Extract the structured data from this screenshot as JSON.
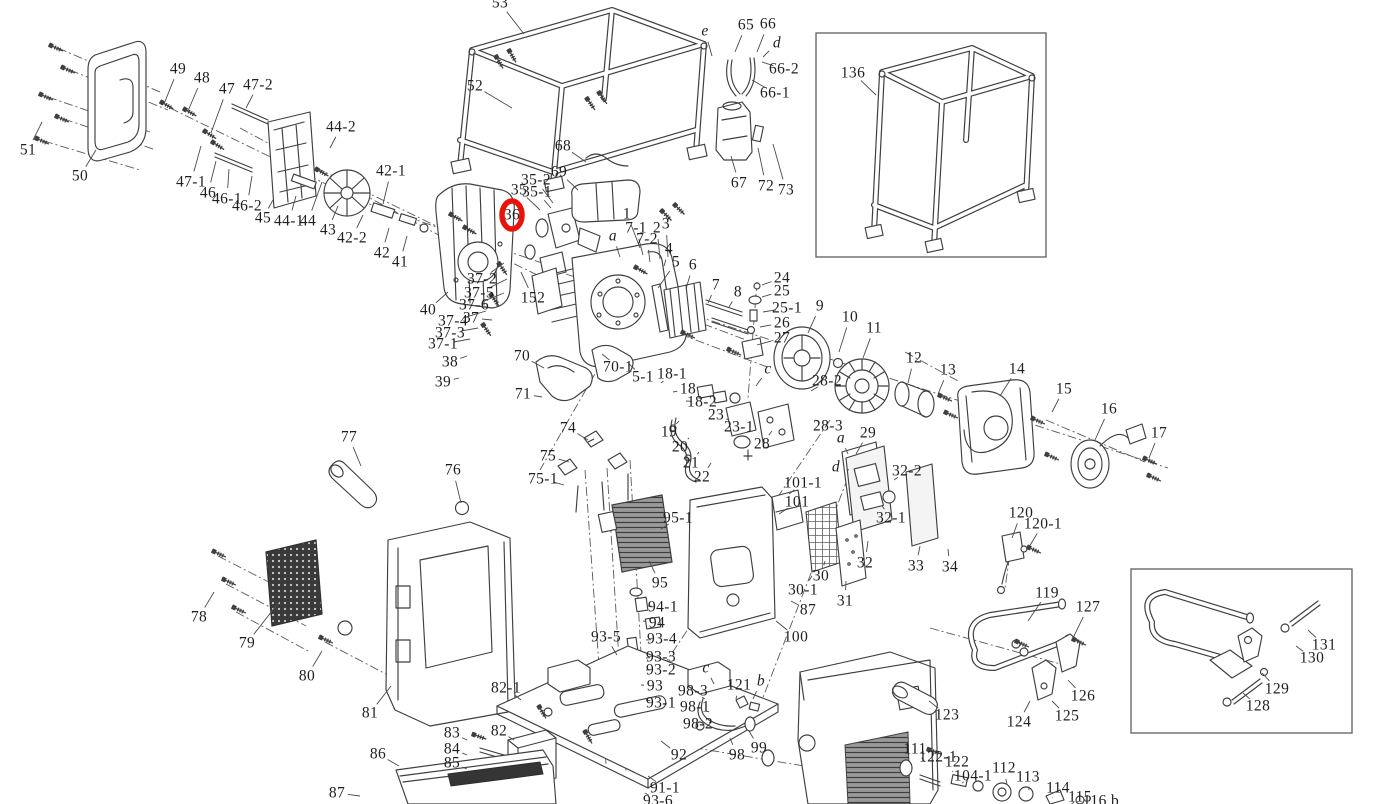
{
  "meta": {
    "background": "#ffffff",
    "line_color": "#3f3f3f",
    "highlight_color": "#e8140c",
    "description": "Exploded-view parts diagram of a portable inverter generator with numbered callouts; part 36 is circled in red; two inset boxes show frame kit 136 and handle kit 128-131."
  },
  "diagram": {
    "highlight": {
      "label": "36",
      "cx": 512,
      "cy": 215,
      "rx": 10,
      "ry": 14,
      "stroke_width": 5.5
    },
    "insets": [
      {
        "name": "frame-inset",
        "x": 816,
        "y": 33,
        "w": 230,
        "h": 224
      },
      {
        "name": "handle-inset",
        "x": 1131,
        "y": 569,
        "w": 221,
        "h": 164
      }
    ],
    "labels": [
      {
        "t": "51",
        "x": 28,
        "y": 150,
        "lx": 42,
        "ly": 122
      },
      {
        "t": "50",
        "x": 80,
        "y": 176,
        "lx": 96,
        "ly": 150
      },
      {
        "t": "49",
        "x": 178,
        "y": 69,
        "lx": 164,
        "ly": 104
      },
      {
        "t": "48",
        "x": 202,
        "y": 78,
        "lx": 188,
        "ly": 111
      },
      {
        "t": "47",
        "x": 227,
        "y": 89,
        "lx": 211,
        "ly": 133
      },
      {
        "t": "47-2",
        "x": 258,
        "y": 85,
        "lx": 246,
        "ly": 108
      },
      {
        "t": "47-1",
        "x": 191,
        "y": 182,
        "lx": 201,
        "ly": 146
      },
      {
        "t": "46",
        "x": 208,
        "y": 193,
        "lx": 216,
        "ly": 161
      },
      {
        "t": "46-1",
        "x": 227,
        "y": 199,
        "lx": 229,
        "ly": 169
      },
      {
        "t": "46-2",
        "x": 247,
        "y": 206,
        "lx": 252,
        "ly": 176
      },
      {
        "t": "45",
        "x": 263,
        "y": 218,
        "lx": 273,
        "ly": 200
      },
      {
        "t": "44-1",
        "x": 289,
        "y": 221,
        "lx": 296,
        "ly": 196
      },
      {
        "t": "44",
        "x": 308,
        "y": 221,
        "lx": 322,
        "ly": 182
      },
      {
        "t": "43",
        "x": 328,
        "y": 230,
        "lx": 338,
        "ly": 206
      },
      {
        "t": "44-2",
        "x": 341,
        "y": 127,
        "lx": 330,
        "ly": 148
      },
      {
        "t": "42-1",
        "x": 391,
        "y": 171,
        "lx": 383,
        "ly": 204
      },
      {
        "t": "42-2",
        "x": 352,
        "y": 238,
        "lx": 363,
        "ly": 215
      },
      {
        "t": "42",
        "x": 382,
        "y": 253,
        "lx": 389,
        "ly": 228
      },
      {
        "t": "41",
        "x": 400,
        "y": 262,
        "lx": 407,
        "ly": 236
      },
      {
        "t": "53",
        "x": 500,
        "y": 3,
        "lx": 524,
        "ly": 34
      },
      {
        "t": "52",
        "x": 475,
        "y": 86,
        "lx": 512,
        "ly": 108
      },
      {
        "t": "68",
        "x": 563,
        "y": 146,
        "lx": 586,
        "ly": 162
      },
      {
        "t": "69",
        "x": 559,
        "y": 172,
        "lx": 578,
        "ly": 190
      },
      {
        "t": "35-2",
        "x": 536,
        "y": 180,
        "lx": 553,
        "ly": 203
      },
      {
        "t": "35",
        "x": 519,
        "y": 190,
        "lx": 540,
        "ly": 210
      },
      {
        "t": "35-1",
        "x": 537,
        "y": 192,
        "lx": 551,
        "ly": 208
      },
      {
        "t": "36",
        "x": 512,
        "y": 215
      },
      {
        "t": "e",
        "x": 705,
        "y": 31,
        "i": 1,
        "lx": 712,
        "ly": 56
      },
      {
        "t": "65",
        "x": 746,
        "y": 25,
        "lx": 735,
        "ly": 52
      },
      {
        "t": "66",
        "x": 768,
        "y": 24,
        "lx": 757,
        "ly": 52
      },
      {
        "t": "d",
        "x": 777,
        "y": 43,
        "i": 1,
        "lx": 763,
        "ly": 57
      },
      {
        "t": "66-2",
        "x": 784,
        "y": 69,
        "lx": 762,
        "ly": 62
      },
      {
        "t": "66-1",
        "x": 775,
        "y": 93,
        "lx": 752,
        "ly": 80
      },
      {
        "t": "67",
        "x": 739,
        "y": 183,
        "lx": 731,
        "ly": 156
      },
      {
        "t": "72",
        "x": 766,
        "y": 186,
        "lx": 758,
        "ly": 148
      },
      {
        "t": "73",
        "x": 786,
        "y": 190,
        "lx": 773,
        "ly": 144
      },
      {
        "t": "136",
        "x": 853,
        "y": 73,
        "lx": 876,
        "ly": 95
      },
      {
        "t": "1",
        "x": 627,
        "y": 214,
        "lx": 640,
        "ly": 248
      },
      {
        "t": "7-1",
        "x": 636,
        "y": 228,
        "lx": 643,
        "ly": 255
      },
      {
        "t": "7-2",
        "x": 647,
        "y": 239,
        "lx": 650,
        "ly": 262
      },
      {
        "t": "2",
        "x": 657,
        "y": 228,
        "lx": 660,
        "ly": 259
      },
      {
        "t": "3",
        "x": 666,
        "y": 224,
        "lx": 668,
        "ly": 257
      },
      {
        "t": "4",
        "x": 669,
        "y": 249,
        "lx": 664,
        "ly": 266
      },
      {
        "t": "a",
        "x": 613,
        "y": 236,
        "i": 1,
        "lx": 620,
        "ly": 257
      },
      {
        "t": "5",
        "x": 676,
        "y": 262,
        "lx": 658,
        "ly": 288
      },
      {
        "t": "6",
        "x": 693,
        "y": 265,
        "lx": 686,
        "ly": 289
      },
      {
        "t": "7",
        "x": 716,
        "y": 285,
        "lx": 708,
        "ly": 303
      },
      {
        "t": "8",
        "x": 738,
        "y": 292,
        "lx": 729,
        "ly": 307
      },
      {
        "t": "24",
        "x": 782,
        "y": 278,
        "lx": 762,
        "ly": 285
      },
      {
        "t": "25",
        "x": 782,
        "y": 291,
        "lx": 762,
        "ly": 297
      },
      {
        "t": "25-1",
        "x": 787,
        "y": 308,
        "lx": 763,
        "ly": 312
      },
      {
        "t": "26",
        "x": 782,
        "y": 323,
        "lx": 760,
        "ly": 327
      },
      {
        "t": "27",
        "x": 782,
        "y": 338,
        "lx": 757,
        "ly": 345
      },
      {
        "t": "9",
        "x": 820,
        "y": 306,
        "lx": 808,
        "ly": 333
      },
      {
        "t": "10",
        "x": 850,
        "y": 317,
        "lx": 839,
        "ly": 352
      },
      {
        "t": "11",
        "x": 874,
        "y": 328,
        "lx": 863,
        "ly": 358
      },
      {
        "t": "12",
        "x": 914,
        "y": 358,
        "lx": 908,
        "ly": 383
      },
      {
        "t": "13",
        "x": 948,
        "y": 370,
        "lx": 938,
        "ly": 394
      },
      {
        "t": "14",
        "x": 1017,
        "y": 369,
        "lx": 1000,
        "ly": 396
      },
      {
        "t": "15",
        "x": 1064,
        "y": 389,
        "lx": 1052,
        "ly": 412
      },
      {
        "t": "16",
        "x": 1109,
        "y": 409,
        "lx": 1095,
        "ly": 440
      },
      {
        "t": "17",
        "x": 1159,
        "y": 433,
        "lx": 1149,
        "ly": 458
      },
      {
        "t": "40",
        "x": 428,
        "y": 310,
        "lx": 448,
        "ly": 292
      },
      {
        "t": "37-2",
        "x": 482,
        "y": 279,
        "lx": 504,
        "ly": 263
      },
      {
        "t": "37-5",
        "x": 479,
        "y": 293,
        "lx": 507,
        "ly": 279
      },
      {
        "t": "37-6",
        "x": 474,
        "y": 305,
        "lx": 504,
        "ly": 293
      },
      {
        "t": "37-4",
        "x": 453,
        "y": 321,
        "lx": 486,
        "ly": 311
      },
      {
        "t": "37",
        "x": 471,
        "y": 318,
        "lx": 492,
        "ly": 320
      },
      {
        "t": "37-3",
        "x": 450,
        "y": 333,
        "lx": 478,
        "ly": 328
      },
      {
        "t": "37-1",
        "x": 443,
        "y": 344,
        "lx": 470,
        "ly": 339
      },
      {
        "t": "38",
        "x": 450,
        "y": 362,
        "lx": 467,
        "ly": 356
      },
      {
        "t": "39",
        "x": 443,
        "y": 382,
        "lx": 459,
        "ly": 378
      },
      {
        "t": "152",
        "x": 533,
        "y": 298,
        "lx": 521,
        "ly": 272
      },
      {
        "t": "70",
        "x": 522,
        "y": 356,
        "lx": 544,
        "ly": 368
      },
      {
        "t": "71",
        "x": 523,
        "y": 394,
        "lx": 542,
        "ly": 397
      },
      {
        "t": "70-1",
        "x": 618,
        "y": 367,
        "lx": 602,
        "ly": 354
      },
      {
        "t": "5-1",
        "x": 643,
        "y": 377,
        "lx": 629,
        "ly": 364
      },
      {
        "t": "18-1",
        "x": 672,
        "y": 374,
        "lx": 661,
        "ly": 383
      },
      {
        "t": "18",
        "x": 688,
        "y": 389,
        "lx": 673,
        "ly": 392
      },
      {
        "t": "18-2",
        "x": 702,
        "y": 402,
        "lx": 686,
        "ly": 401
      },
      {
        "t": "23",
        "x": 716,
        "y": 415,
        "lx": 729,
        "ly": 420
      },
      {
        "t": "23-1",
        "x": 739,
        "y": 427,
        "lx": 747,
        "ly": 419
      },
      {
        "t": "c",
        "x": 768,
        "y": 369,
        "i": 1,
        "lx": 756,
        "ly": 386
      },
      {
        "t": "28-2",
        "x": 827,
        "y": 381,
        "lx": 811,
        "ly": 391
      },
      {
        "t": "28-3",
        "x": 828,
        "y": 426,
        "lx": 815,
        "ly": 420
      },
      {
        "t": "28",
        "x": 762,
        "y": 444,
        "lx": 772,
        "ly": 431
      },
      {
        "t": "19",
        "x": 669,
        "y": 432,
        "lx": 679,
        "ly": 421
      },
      {
        "t": "20",
        "x": 680,
        "y": 447,
        "lx": 689,
        "ly": 438
      },
      {
        "t": "21",
        "x": 691,
        "y": 463,
        "lx": 699,
        "ly": 452
      },
      {
        "t": "22",
        "x": 702,
        "y": 477,
        "lx": 711,
        "ly": 463
      },
      {
        "t": "29",
        "x": 868,
        "y": 433,
        "lx": 856,
        "ly": 454
      },
      {
        "t": "a",
        "x": 841,
        "y": 438,
        "i": 1,
        "lx": 848,
        "ly": 454
      },
      {
        "t": "d",
        "x": 836,
        "y": 467,
        "i": 1,
        "lx": 849,
        "ly": 470
      },
      {
        "t": "32-2",
        "x": 907,
        "y": 471,
        "lx": 894,
        "ly": 480
      },
      {
        "t": "32-1",
        "x": 891,
        "y": 518,
        "lx": 882,
        "ly": 506
      },
      {
        "t": "74",
        "x": 568,
        "y": 428,
        "lx": 588,
        "ly": 440
      },
      {
        "t": "75",
        "x": 548,
        "y": 456,
        "lx": 569,
        "ly": 462
      },
      {
        "t": "75-1",
        "x": 543,
        "y": 479,
        "lx": 564,
        "ly": 485
      },
      {
        "t": "77",
        "x": 349,
        "y": 437,
        "lx": 361,
        "ly": 466
      },
      {
        "t": "76",
        "x": 453,
        "y": 470,
        "lx": 461,
        "ly": 503
      },
      {
        "t": "78",
        "x": 199,
        "y": 617,
        "lx": 214,
        "ly": 592
      },
      {
        "t": "79",
        "x": 247,
        "y": 643,
        "lx": 279,
        "ly": 602
      },
      {
        "t": "80",
        "x": 307,
        "y": 676,
        "lx": 322,
        "ly": 651
      },
      {
        "t": "81",
        "x": 370,
        "y": 713,
        "lx": 391,
        "ly": 686
      },
      {
        "t": "101-1",
        "x": 803,
        "y": 483,
        "lx": 789,
        "ly": 494
      },
      {
        "t": "101",
        "x": 797,
        "y": 502,
        "lx": 779,
        "ly": 514
      },
      {
        "t": "95-1",
        "x": 678,
        "y": 518,
        "lx": 661,
        "ly": 529
      },
      {
        "t": "95",
        "x": 660,
        "y": 583,
        "lx": 649,
        "ly": 561
      },
      {
        "t": "94-1",
        "x": 663,
        "y": 607,
        "lx": 648,
        "ly": 606
      },
      {
        "t": "94",
        "x": 657,
        "y": 623,
        "lx": 643,
        "ly": 621
      },
      {
        "t": "93-5",
        "x": 606,
        "y": 637,
        "lx": 617,
        "ly": 655
      },
      {
        "t": "93-4",
        "x": 662,
        "y": 639,
        "lx": 646,
        "ly": 640
      },
      {
        "t": "93-3",
        "x": 661,
        "y": 657,
        "lx": 646,
        "ly": 658
      },
      {
        "t": "93-2",
        "x": 661,
        "y": 670,
        "lx": 646,
        "ly": 670
      },
      {
        "t": "93",
        "x": 655,
        "y": 686,
        "lx": 641,
        "ly": 685
      },
      {
        "t": "93-1",
        "x": 661,
        "y": 703,
        "lx": 646,
        "ly": 700
      },
      {
        "t": "30-1",
        "x": 803,
        "y": 590,
        "lx": 812,
        "ly": 576
      },
      {
        "t": "30",
        "x": 821,
        "y": 576,
        "lx": 825,
        "ly": 561
      },
      {
        "t": "31",
        "x": 845,
        "y": 601,
        "lx": 846,
        "ly": 581
      },
      {
        "t": "32",
        "x": 865,
        "y": 563,
        "lx": 868,
        "ly": 541
      },
      {
        "t": "33",
        "x": 916,
        "y": 566,
        "lx": 920,
        "ly": 546
      },
      {
        "t": "34",
        "x": 950,
        "y": 567,
        "lx": 948,
        "ly": 549
      },
      {
        "t": "87",
        "x": 808,
        "y": 610,
        "lx": 791,
        "ly": 601
      },
      {
        "t": "100",
        "x": 796,
        "y": 637,
        "lx": 776,
        "ly": 621
      },
      {
        "t": "82-1",
        "x": 506,
        "y": 688,
        "lx": 521,
        "ly": 700
      },
      {
        "t": "82",
        "x": 499,
        "y": 731,
        "lx": 514,
        "ly": 740
      },
      {
        "t": "83",
        "x": 452,
        "y": 733,
        "lx": 467,
        "ly": 740
      },
      {
        "t": "84",
        "x": 452,
        "y": 749,
        "lx": 467,
        "ly": 755
      },
      {
        "t": "85",
        "x": 452,
        "y": 763,
        "lx": 467,
        "ly": 769
      },
      {
        "t": "86",
        "x": 378,
        "y": 754,
        "lx": 399,
        "ly": 766
      },
      {
        "t": "87",
        "x": 337,
        "y": 793,
        "lx": 360,
        "ly": 796
      },
      {
        "t": "98-3",
        "x": 693,
        "y": 691,
        "lx": 705,
        "ly": 699
      },
      {
        "t": "98-1",
        "x": 695,
        "y": 707,
        "lx": 709,
        "ly": 712
      },
      {
        "t": "98-2",
        "x": 698,
        "y": 724,
        "lx": 712,
        "ly": 722
      },
      {
        "t": "c",
        "x": 706,
        "y": 668,
        "i": 1,
        "lx": 714,
        "ly": 684
      },
      {
        "t": "121",
        "x": 739,
        "y": 685,
        "lx": 736,
        "ly": 699
      },
      {
        "t": "b",
        "x": 761,
        "y": 681,
        "i": 1,
        "lx": 753,
        "ly": 699
      },
      {
        "t": "99",
        "x": 759,
        "y": 748,
        "lx": 749,
        "ly": 731
      },
      {
        "t": "98",
        "x": 737,
        "y": 755,
        "lx": 730,
        "ly": 738
      },
      {
        "t": "92",
        "x": 679,
        "y": 755,
        "lx": 661,
        "ly": 741
      },
      {
        "t": "91-1",
        "x": 665,
        "y": 788,
        "lx": 648,
        "ly": 776
      },
      {
        "t": "93-6",
        "x": 658,
        "y": 801,
        "lx": 645,
        "ly": 793
      },
      {
        "t": "119",
        "x": 1047,
        "y": 593,
        "lx": 1028,
        "ly": 621
      },
      {
        "t": "127",
        "x": 1088,
        "y": 607,
        "lx": 1073,
        "ly": 638
      },
      {
        "t": "126",
        "x": 1083,
        "y": 696,
        "lx": 1068,
        "ly": 680
      },
      {
        "t": "125",
        "x": 1067,
        "y": 716,
        "lx": 1052,
        "ly": 701
      },
      {
        "t": "124",
        "x": 1019,
        "y": 722,
        "lx": 1030,
        "ly": 701
      },
      {
        "t": "123",
        "x": 947,
        "y": 715,
        "lx": 929,
        "ly": 701
      },
      {
        "t": "120",
        "x": 1021,
        "y": 513,
        "lx": 1012,
        "ly": 538
      },
      {
        "t": "120-1",
        "x": 1043,
        "y": 524,
        "lx": 1029,
        "ly": 547
      },
      {
        "t": "111",
        "x": 915,
        "y": 749,
        "lx": 925,
        "ly": 762
      },
      {
        "t": "122-1",
        "x": 938,
        "y": 757,
        "lx": 944,
        "ly": 766
      },
      {
        "t": "122",
        "x": 957,
        "y": 762,
        "lx": 953,
        "ly": 771
      },
      {
        "t": "104-1",
        "x": 973,
        "y": 776,
        "lx": 962,
        "ly": 783
      },
      {
        "t": "112",
        "x": 1004,
        "y": 768,
        "lx": 1007,
        "ly": 785
      },
      {
        "t": "113",
        "x": 1028,
        "y": 777,
        "lx": 1029,
        "ly": 790
      },
      {
        "t": "114",
        "x": 1058,
        "y": 788,
        "lx": 1052,
        "ly": 798
      },
      {
        "t": "115",
        "x": 1080,
        "y": 797,
        "lx": 1074,
        "ly": 802
      },
      {
        "t": "116 b",
        "x": 1101,
        "y": 801
      },
      {
        "t": "131",
        "x": 1324,
        "y": 645,
        "lx": 1308,
        "ly": 630
      },
      {
        "t": "130",
        "x": 1312,
        "y": 658,
        "lx": 1296,
        "ly": 646
      },
      {
        "t": "129",
        "x": 1277,
        "y": 689,
        "lx": 1262,
        "ly": 673
      },
      {
        "t": "128",
        "x": 1258,
        "y": 706,
        "lx": 1243,
        "ly": 693
      }
    ]
  }
}
